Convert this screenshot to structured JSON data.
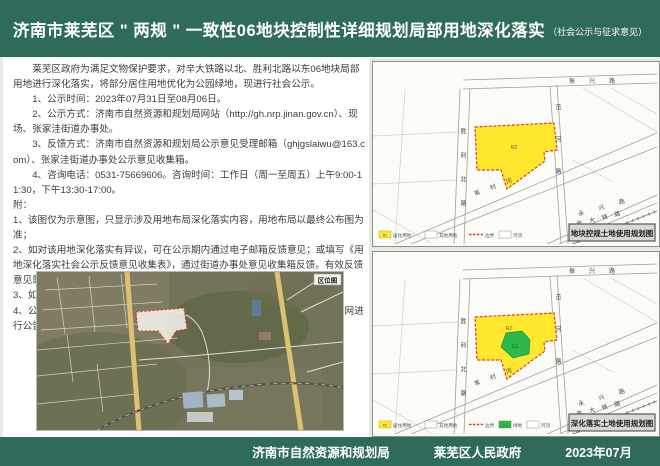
{
  "header": {
    "title": "济南市莱芜区 \" 两规 \" 一致性06地块控制性详细规划局部用地深化落实",
    "subtitle": "（社会公示与征求意见）"
  },
  "notice": {
    "intro": "莱芜区政府为满足文物保护要求，对辛大铁路以北、胜利北路以东06地块局部用地进行深化落实，将部分居住用地优化为公园绿地，现进行社会公示。",
    "items": [
      "1、公示时间：2023年07月31日至08月06日。",
      "2、公示方式：济南市自然资源和规划局网站（http://gh.nrp.jinan.gov.cn）、现场、张家洼街道办事处。",
      "3、反馈方式：济南市自然资源和规划局公示意见受理邮箱（ghjgslaiwu@163.com）、张家洼街道办事处公示意见收集箱。",
      "4、咨询电话：0531-75669606。咨询时间：工作日（周一至周五）上午9:00-11:30，下午13:30-17:00。"
    ],
    "appendix_label": "附：",
    "appendix": [
      "1、该图仅为示意图，只显示涉及用地布局深化落实内容，用地布局以最终公布图为准；",
      "2、如对该用地深化落实有异议，可在公示期内通过电子邮箱反馈意见；或填写《用地深化落实社会公示反馈意见收集表》，通过街道办事处意见收集箱反馈。有效反馈意见需注明联系人、联系电话、联系地址。",
      "3、如涉及深化落实的动因及建设实施等事宜，请拨打咨询电话。",
      "4、公示意见收集、采纳情况及深化最终方案将通过济南市自然资源和规划局官网进行公告。"
    ]
  },
  "location_map": {
    "label": "区位图"
  },
  "roads": {
    "zhenxing": "振兴路",
    "shengli": "胜利北路",
    "xianhe": "苋河路",
    "weicun": "苇村河",
    "yongxing": "永兴路",
    "railway": "辛大铁路"
  },
  "maps": {
    "top": {
      "caption": "地块控规土地使用规划图",
      "parcel_label": "R2",
      "legend": [
        {
          "code": "R2",
          "label": "居住用地"
        },
        {
          "label": "其他用地"
        },
        {
          "label": "边界"
        },
        {
          "label": "河流"
        }
      ]
    },
    "bottom": {
      "caption": "深化落实土地使用规划图",
      "parcel_label": "R2",
      "park_label": "G1",
      "legend": [
        {
          "code": "R2",
          "label": "居住用地"
        },
        {
          "label": "其他用地"
        },
        {
          "label": "边界"
        },
        {
          "code": "G1",
          "label": "绿地"
        },
        {
          "label": "河流"
        }
      ]
    }
  },
  "footer": {
    "authority": "济南市自然资源和规划局",
    "government": "莱芜区人民政府",
    "date": "2023年07月"
  },
  "colors": {
    "header_green": "#2e6b5a",
    "parcel_yellow": "#ffe82e",
    "park_green": "#2eb84d",
    "boundary_red": "#e03b24",
    "road_yellow": "#dcc172"
  }
}
